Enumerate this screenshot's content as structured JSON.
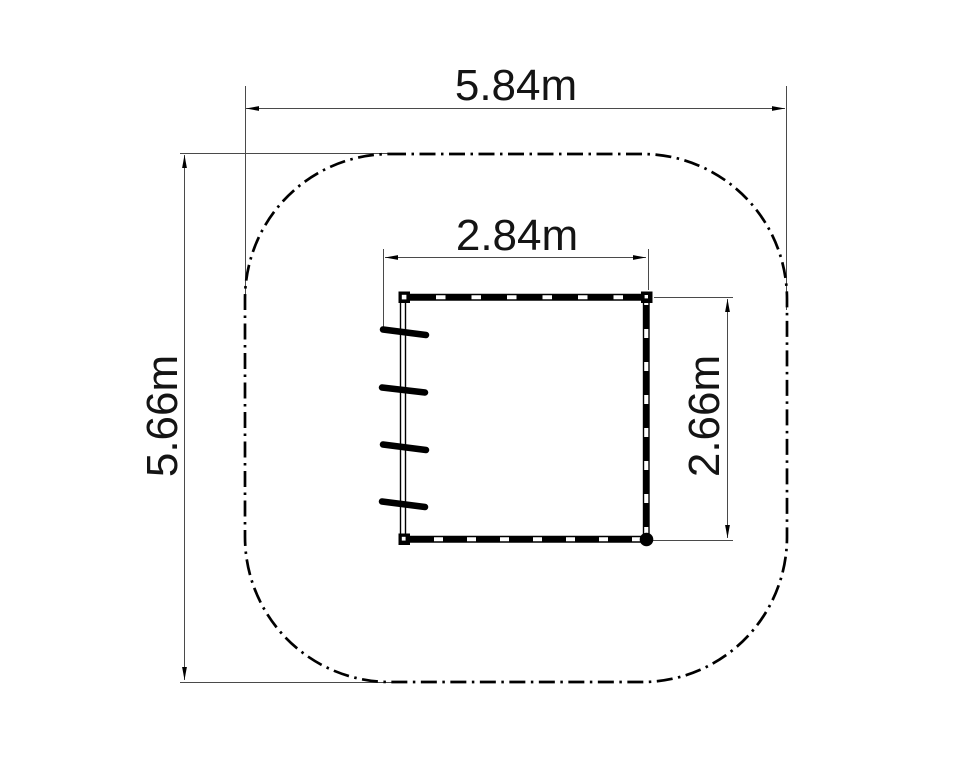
{
  "drawing": {
    "dimensions": {
      "outer_width": "5.84m",
      "outer_height": "5.66m",
      "inner_width": "2.84m",
      "inner_height": "2.66m"
    },
    "colors": {
      "background": "#ffffff",
      "drawing_line": "#000000",
      "dimension_line": "#4a4a4a",
      "text": "#141414"
    }
  }
}
